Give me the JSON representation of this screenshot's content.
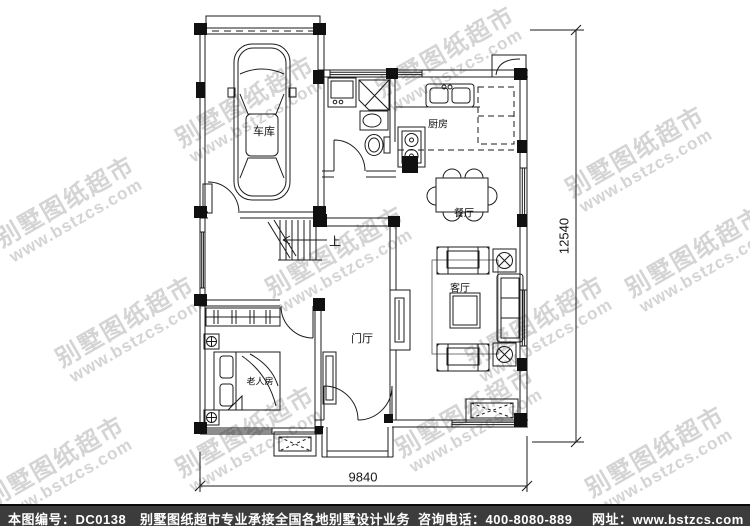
{
  "watermark": {
    "brand": "别墅图纸超市",
    "url": "www.bstzcs.com"
  },
  "plan": {
    "labels": {
      "garage": "车库",
      "kitchen": "厨房",
      "dining": "餐厅",
      "living": "客厅",
      "hall": "门厅",
      "elder_room": "老人房",
      "stairs_up": "上"
    },
    "dimensions": {
      "overall_width_mm": "9840",
      "overall_depth_mm": "12540"
    }
  },
  "footer": {
    "drawing_no": "本图编号：DC0138",
    "service": "别墅图纸超市专业承接全国各地别墅设计业务",
    "phone": "咨询电话：400-8080-889",
    "website": "网址：www.bstzcs.com"
  },
  "colors": {
    "line": "#1b1b1b",
    "watermark": "#d4d4d4",
    "footer_bg": "#3c3c3c",
    "footer_text": "#ffffff"
  }
}
